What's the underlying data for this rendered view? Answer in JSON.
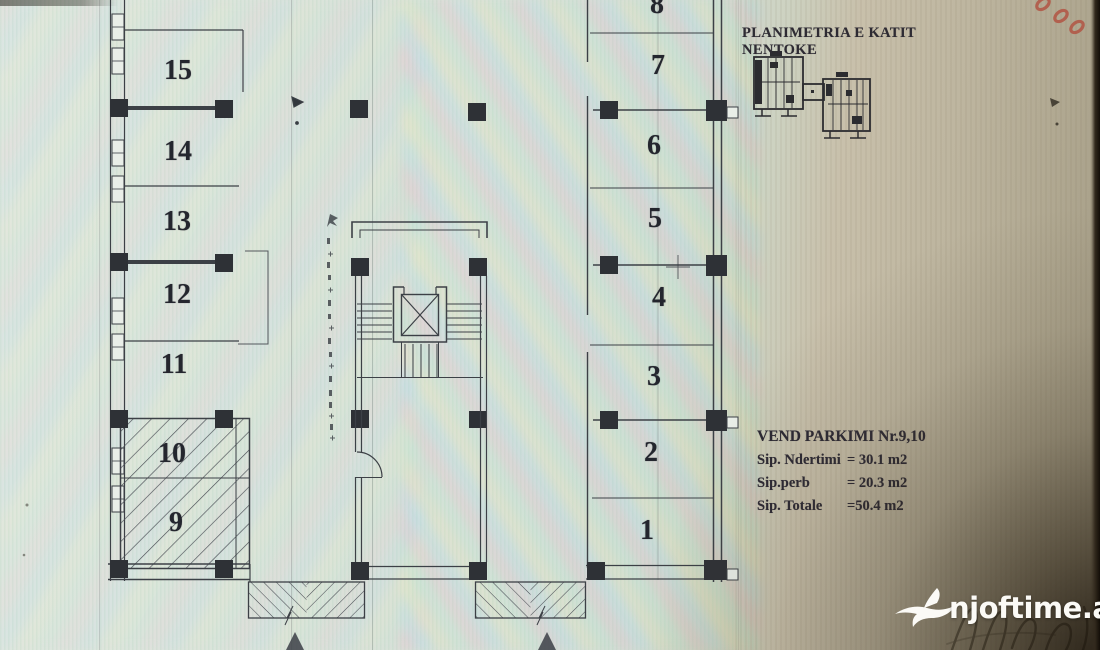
{
  "document": {
    "title": "PLANIMETRIA E KATIT NENTOKE",
    "parking_info": {
      "heading": "VEND PARKIMI  Nr.9,10",
      "rows": [
        {
          "label": "Sip. Ndertimi",
          "value": "= 30.1 m2"
        },
        {
          "label": "Sip.perb",
          "value": "= 20.3 m2"
        },
        {
          "label": "Sip. Totale",
          "value": "=50.4 m2"
        }
      ]
    },
    "spots": {
      "s1": "1",
      "s2": "2",
      "s3": "3",
      "s4": "4",
      "s5": "5",
      "s6": "6",
      "s7": "7",
      "s8": "8",
      "s9": "9",
      "s10": "10",
      "s11": "11",
      "s12": "12",
      "s13": "13",
      "s14": "14",
      "s15": "15"
    },
    "highlighted_spots": "9,10",
    "watermark": "njoftime.al",
    "colors": {
      "ink": "#3c4046",
      "paper_left": "#d8e1d8",
      "paper_right": "#c1b9a4",
      "red_ink": "#b25544",
      "watermark_white": "#fbfaf6"
    }
  }
}
